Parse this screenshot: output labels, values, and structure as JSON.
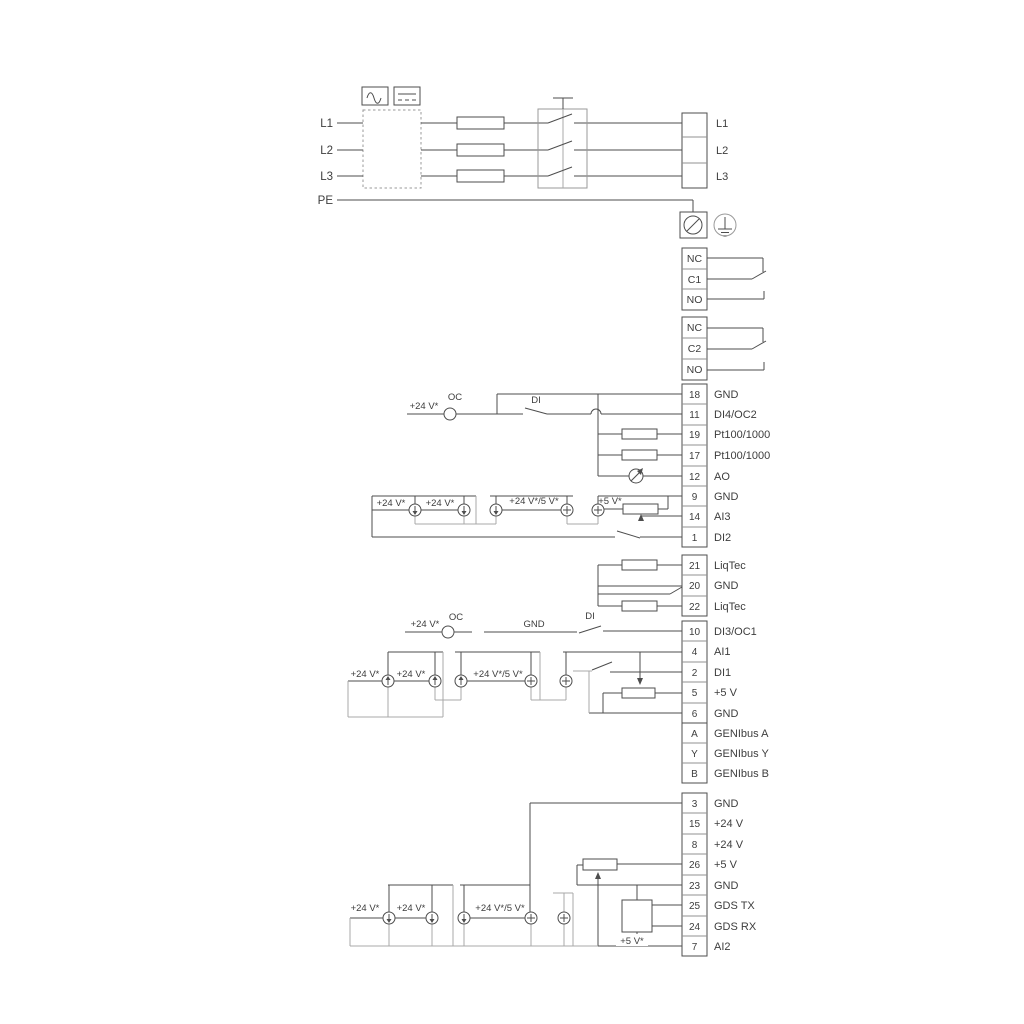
{
  "colors": {
    "line": "#4d4d4d",
    "grey": "#a8a8a8",
    "text": "#3d3d3d",
    "background": "#ffffff"
  },
  "power": {
    "inputs": [
      "L1",
      "L2",
      "L3",
      "PE"
    ],
    "outputs": [
      "L1",
      "L2",
      "L3"
    ]
  },
  "relays": {
    "r1": [
      "NC",
      "C1",
      "NO"
    ],
    "r2": [
      "NC",
      "C2",
      "NO"
    ]
  },
  "strips": {
    "io1": [
      {
        "n": "18",
        "label": "GND"
      },
      {
        "n": "11",
        "label": "DI4/OC2"
      },
      {
        "n": "19",
        "label": "Pt100/1000"
      },
      {
        "n": "17",
        "label": "Pt100/1000"
      },
      {
        "n": "12",
        "label": "AO"
      },
      {
        "n": "9",
        "label": "GND"
      },
      {
        "n": "14",
        "label": "AI3"
      },
      {
        "n": "1",
        "label": "DI2"
      }
    ],
    "liqtec": [
      {
        "n": "21",
        "label": "LiqTec"
      },
      {
        "n": "20",
        "label": "GND"
      },
      {
        "n": "22",
        "label": "LiqTec"
      }
    ],
    "io2": [
      {
        "n": "10",
        "label": "DI3/OC1"
      },
      {
        "n": "4",
        "label": "AI1"
      },
      {
        "n": "2",
        "label": "DI1"
      },
      {
        "n": "5",
        "label": "+5 V"
      },
      {
        "n": "6",
        "label": "GND"
      }
    ],
    "genibus": [
      {
        "n": "A",
        "label": "GENIbus A"
      },
      {
        "n": "Y",
        "label": "GENIbus Y"
      },
      {
        "n": "B",
        "label": "GENIbus B"
      }
    ],
    "io3": [
      {
        "n": "3",
        "label": "GND"
      },
      {
        "n": "15",
        "label": "+24 V"
      },
      {
        "n": "8",
        "label": "+24 V"
      },
      {
        "n": "26",
        "label": "+5 V"
      },
      {
        "n": "23",
        "label": "GND"
      },
      {
        "n": "25",
        "label": "GDS TX"
      },
      {
        "n": "24",
        "label": "GDS RX"
      },
      {
        "n": "7",
        "label": "AI2"
      }
    ]
  },
  "ann": {
    "a_v24": "+24 V*",
    "a_oc": "OC",
    "a_di": "DI",
    "b_v24a": "+24 V*",
    "b_v24b": "+24 V*",
    "b_v245": "+24 V*/5 V*",
    "b_v5": "+5 V*",
    "d_v24": "+24 V*",
    "d_oc": "OC",
    "d_gnd": "GND",
    "d_di": "DI",
    "e_v24a": "+24 V*",
    "e_v24b": "+24 V*",
    "e_v245": "+24 V*/5 V*",
    "f_v24a": "+24 V*",
    "f_v24b": "+24 V*",
    "f_v245": "+24 V*/5 V*",
    "f_v5": "+5 V*"
  }
}
